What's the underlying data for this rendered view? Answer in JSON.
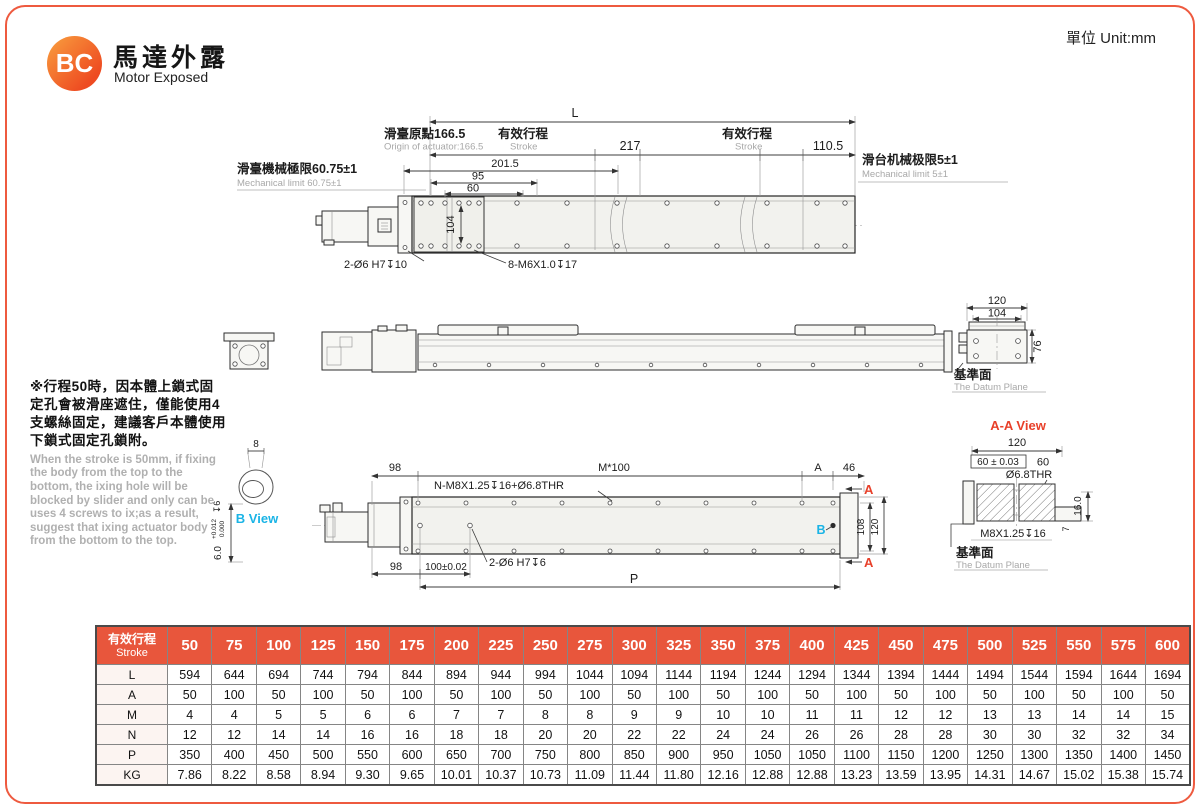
{
  "page": {
    "unit_label": "單位 Unit:mm"
  },
  "header": {
    "logo_text": "BC",
    "title_zh": "馬達外露",
    "title_en": "Motor Exposed"
  },
  "note": {
    "zh": "※行程50時，因本體上鎖式固定孔會被滑座遮住，僅能使用4支螺絲固定，建議客戶本體使用下鎖式固定孔鎖附。",
    "en": "When the stroke is 50mm, if fixing the body from the top to the bottom, the ixing hole will be blocked by slider and only can be uses 4 screws to ix;as a result, suggest that ixing actuator body from the bottom to the top."
  },
  "top_view": {
    "dim_L": "L",
    "origin_zh": "滑臺原點166.5",
    "origin_en": "Origin of actuator:166.5",
    "stroke_zh": "有效行程",
    "stroke_en": "Stroke",
    "dim_217": "217",
    "dim_110_5": "110.5",
    "limit_left_zh": "滑臺機械極限60.75±1",
    "limit_left_en": "Mechanical limit 60.75±1",
    "limit_right_zh": "滑台机械极限5±1",
    "limit_right_en": "Mechanical limit 5±1",
    "dim_201_5": "201.5",
    "dim_95": "95",
    "dim_60": "60",
    "dim_104": "104",
    "holes_label_1": "2-Ø6 H7↧10",
    "holes_label_2": "8-M6X1.0↧17"
  },
  "section_view": {
    "dim_120": "120",
    "dim_104": "104",
    "dim_76": "76",
    "datum_zh": "基準面",
    "datum_en": "The Datum Plane"
  },
  "b_view": {
    "dim_8": "8",
    "label": "B View",
    "tol_main": "6.0",
    "tol_upper": "+0.012",
    "tol_lower": "0.000",
    "tol_depth": "↧6"
  },
  "bottom_view": {
    "dim_98_top": "98",
    "dim_M100": "M*100",
    "dim_A": "A",
    "dim_46": "46",
    "holes_label_top": "N-M8X1.25↧16+Ø6.8THR",
    "holes_label_mid": "2-Ø6 H7↧6",
    "dim_98_bottom": "98",
    "dim_100": "100±0.02",
    "dim_P": "P",
    "dim_108": "108",
    "dim_120": "120",
    "section_mark": "A",
    "detail_mark": "B"
  },
  "aa_view": {
    "title": "A-A View",
    "dim_120": "120",
    "dim_60_tol": "60 ± 0.03",
    "dim_60": "60",
    "dim_thr": "Ø6.8THR",
    "dim_16": "16.0",
    "thread_label": "M8X1.25↧16",
    "dim_7": "7",
    "datum_zh": "基準面",
    "datum_en": "The Datum Plane"
  },
  "table": {
    "header_zh": "有效行程",
    "header_en": "Stroke",
    "strokes": [
      50,
      75,
      100,
      125,
      150,
      175,
      200,
      225,
      250,
      275,
      300,
      325,
      350,
      375,
      400,
      425,
      450,
      475,
      500,
      525,
      550,
      575,
      600
    ],
    "rows": [
      {
        "label": "L",
        "values": [
          594,
          644,
          694,
          744,
          794,
          844,
          894,
          944,
          994,
          1044,
          1094,
          1144,
          1194,
          1244,
          1294,
          1344,
          1394,
          1444,
          1494,
          1544,
          1594,
          1644,
          1694
        ]
      },
      {
        "label": "A",
        "values": [
          50,
          100,
          50,
          100,
          50,
          100,
          50,
          100,
          50,
          100,
          50,
          100,
          50,
          100,
          50,
          100,
          50,
          100,
          50,
          100,
          50,
          100,
          50
        ]
      },
      {
        "label": "M",
        "values": [
          4,
          4,
          5,
          5,
          6,
          6,
          7,
          7,
          8,
          8,
          9,
          9,
          10,
          10,
          11,
          11,
          12,
          12,
          13,
          13,
          14,
          14,
          15
        ]
      },
      {
        "label": "N",
        "values": [
          12,
          12,
          14,
          14,
          16,
          16,
          18,
          18,
          20,
          20,
          22,
          22,
          24,
          24,
          26,
          26,
          28,
          28,
          30,
          30,
          32,
          32,
          34
        ]
      },
      {
        "label": "P",
        "values": [
          350,
          400,
          450,
          500,
          550,
          600,
          650,
          700,
          750,
          800,
          850,
          900,
          950,
          1050,
          1050,
          1100,
          1150,
          1200,
          1250,
          1300,
          1350,
          1400,
          1450
        ]
      },
      {
        "label": "KG",
        "values": [
          "7.86",
          "8.22",
          "8.58",
          "8.94",
          "9.30",
          "9.65",
          "10.01",
          "10.37",
          "10.73",
          "11.09",
          "11.44",
          "11.80",
          "12.16",
          "12.88",
          "12.88",
          "13.23",
          "13.59",
          "13.95",
          "14.31",
          "14.67",
          "15.02",
          "15.38",
          "15.74"
        ]
      }
    ]
  },
  "colors": {
    "accent": "#ee5a3f",
    "table_header": "#e8563c",
    "red_mark": "#e8402a",
    "cyan_mark": "#1ab4e6"
  }
}
